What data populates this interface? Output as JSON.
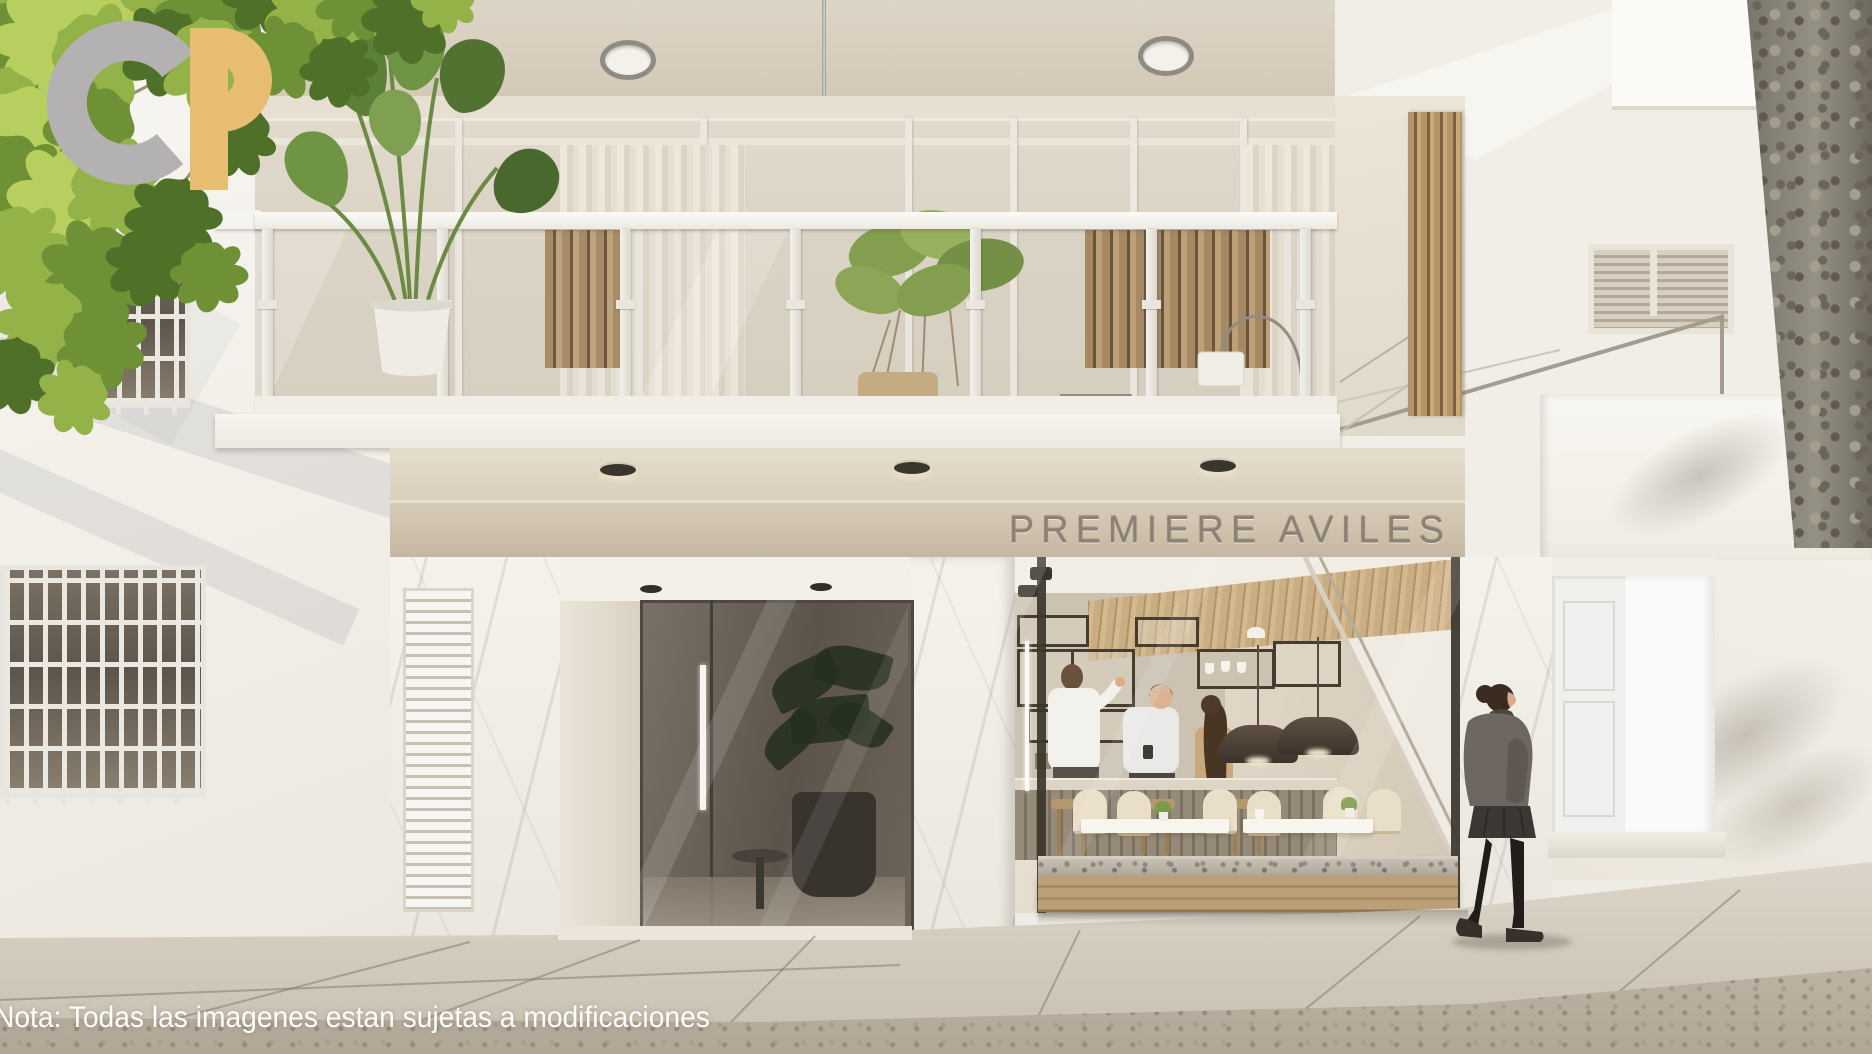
{
  "facade": {
    "sign": "PREMIERE AVILES",
    "sign_color": "#8d8176",
    "band_color": "#cdc0ab"
  },
  "overlay": {
    "note": "Nota: Todas las imagenes estan sujetas a modificaciones",
    "note_color": "#fdfdfc"
  },
  "logo": {
    "letter_g": "G",
    "letter_p": "P",
    "g_color": "#b4b1b2",
    "p_color": "#e7bd72"
  },
  "palette": {
    "wall_white": "#f4f1ec",
    "ceiling_beige": "#d6cdbb",
    "foliage_green": "#93b248",
    "wood_slats": "#a98c63",
    "entrance_dark": "#5c544a",
    "pavement": "#d3cbbe",
    "granite_planter": "#b2aba0",
    "pendant_lamp": "#3b332b",
    "marble": "#f3f0ea"
  },
  "scene": {
    "people_inside_cafe": 3,
    "pedestrians": 1,
    "ceiling_recessed_lights": 2,
    "soffit_lights": 3
  }
}
